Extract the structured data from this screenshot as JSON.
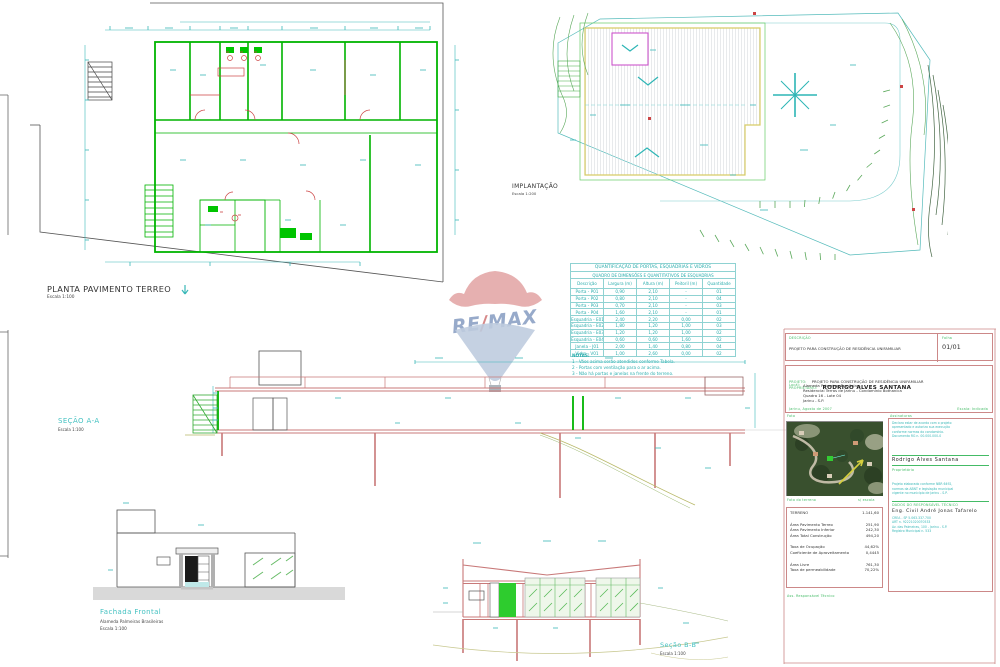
{
  "palette": {
    "annotation_cyan": "#3ab8b8",
    "wall_green": "#00b400",
    "detail_red": "#cc4444",
    "section_salmon": "#c87878",
    "skylight_magenta": "#cc55cc",
    "roof_yellow": "#d8cc66",
    "titleblock_red": "#cc8888",
    "label_green": "#44bb66",
    "remax_red": "#d98585",
    "remax_blue": "#7e95bd"
  },
  "drawings": {
    "planta": {
      "title": "PLANTA PAVIMENTO TERREO",
      "scale": "Escala 1:100"
    },
    "implantacao": {
      "title": "IMPLANTAÇÃO",
      "scale": "Escala 1:200"
    },
    "secao_aa": {
      "title": "SEÇÃO A-A",
      "scale": "Escala 1:100"
    },
    "fachada": {
      "title": "Fachada Frontal",
      "subtitle": "Alameda Palmeiras Brasileiras",
      "scale": "Escala 1:100"
    },
    "secao_bb": {
      "title": "Seção B-B",
      "scale": "Escala 1:100"
    }
  },
  "logo": {
    "re": "RE",
    "slash": "/",
    "max": "MAX"
  },
  "schedule": {
    "title": "QUANTIFICAÇÃO DE PORTAS, ESQUADRIAS E VIDROS",
    "subtitle": "QUADRO DE DIMENSÕES E QUANTITATIVOS DE ESQUADRIAS",
    "columns": [
      "Descrição",
      "Largura (m)",
      "Altura (m)",
      "Peitoril (m)",
      "Quantidade"
    ],
    "rows": [
      [
        "Porta - P01",
        "0,90",
        "2,10",
        "-",
        "01"
      ],
      [
        "Porta - P02",
        "0,80",
        "2,10",
        "-",
        "04"
      ],
      [
        "Porta - P03",
        "0,70",
        "2,10",
        "-",
        "03"
      ],
      [
        "Porta - P04",
        "1,60",
        "2,10",
        "-",
        "01"
      ],
      [
        "Esquadria - E01",
        "2,40",
        "2,20",
        "0,00",
        "02"
      ],
      [
        "Esquadria - E02",
        "1,80",
        "1,20",
        "1,00",
        "03"
      ],
      [
        "Esquadria - E03",
        "1,20",
        "1,20",
        "1,00",
        "02"
      ],
      [
        "Esquadria - E04",
        "0,60",
        "0,60",
        "1,60",
        "02"
      ],
      [
        "Janela - J01",
        "2,00",
        "1,40",
        "0,80",
        "04"
      ],
      [
        "Vidro - V01",
        "1,00",
        "2,60",
        "0,00",
        "02"
      ]
    ],
    "notes_label": "NOTAS:",
    "notes": [
      "1 - Vãos acima serão atendidos conforme Tabela.",
      "2 - Portas com ventilação para o ar acima.",
      "3 - Não há portas e janelas na frente do terreno."
    ]
  },
  "titleblock": {
    "info_label": "DESCRIÇÃO",
    "info_value": "PROJETO PARA CONSTRUÇÃO DE RESIDÊNCIA UNIFAMILIAR",
    "sheet_label": "Folha",
    "sheet_value": "01/01",
    "project_label": "PROJETO:",
    "project_value": "PROJETO PARA CONSTRUÇÃO DE RESIDÊNCIA UNIFAMILIAR",
    "owner_label": "PROPRIETÁRIO:",
    "owner_value": "RODRIGO ALVES SANTANA",
    "local_label": "Local:",
    "address_lines": [
      "Alameda Palmeiras Brasileiras",
      "Residencial Terras de Jarinu - Condomínio Bothanica",
      "Quadra 16 - Lote 04",
      "Jarinu - S.P."
    ],
    "date_line": "Jarinu, Agosto de 2007",
    "scale_note": "Escala: Indicada",
    "photo_header": "Foto",
    "sign_header": "Assinaturas",
    "photo_label": "Foto do terreno",
    "photo_note": "s/ escala",
    "owner_lines": [
      "Declaro estar de acordo com o projeto",
      "apresentado e autorizo sua execução",
      "conforme normas do condomínio.",
      "Documento RG n. 00.000.000-0"
    ],
    "owner_sign_name": "Rodrigo Alves Santana",
    "owner_sign_label": "Proprietário",
    "areas_rows": [
      [
        "TERRENO",
        "1.141,60"
      ],
      [
        "Área Pavimento Terreo",
        "251,90"
      ],
      [
        "Área Pavimento Inferior",
        "242,30"
      ],
      [
        "Área Total Construção",
        "494,20"
      ],
      [
        "Taxa de Ocupação",
        "44,62%"
      ],
      [
        "Coeficiente de Aproveitamento",
        "0,4445"
      ],
      [
        "Área Livre",
        "761,30"
      ],
      [
        "Taxa de permeabilidade",
        "70,22%"
      ]
    ],
    "resp_top_lines": [
      "Projeto elaborado conforme NBR 6492,",
      "normas da ABNT e legislação municipal",
      "vigente no município de Jarinu - S.P."
    ],
    "resp_header": "DADOS DO RESPONSÁVEL TÉCNICO",
    "resp_name": "Eng. Civil André Jonas Tafarelo",
    "resp_bottom_lines": [
      "CREA - SP 5.063.337.700",
      "ART n. 92221020070533",
      "Av. das Palmeiras, 100 - Jarinu - S.P.",
      "Registro Municipal n. 533"
    ],
    "footer_label": "Ass. Responsável Técnico"
  }
}
